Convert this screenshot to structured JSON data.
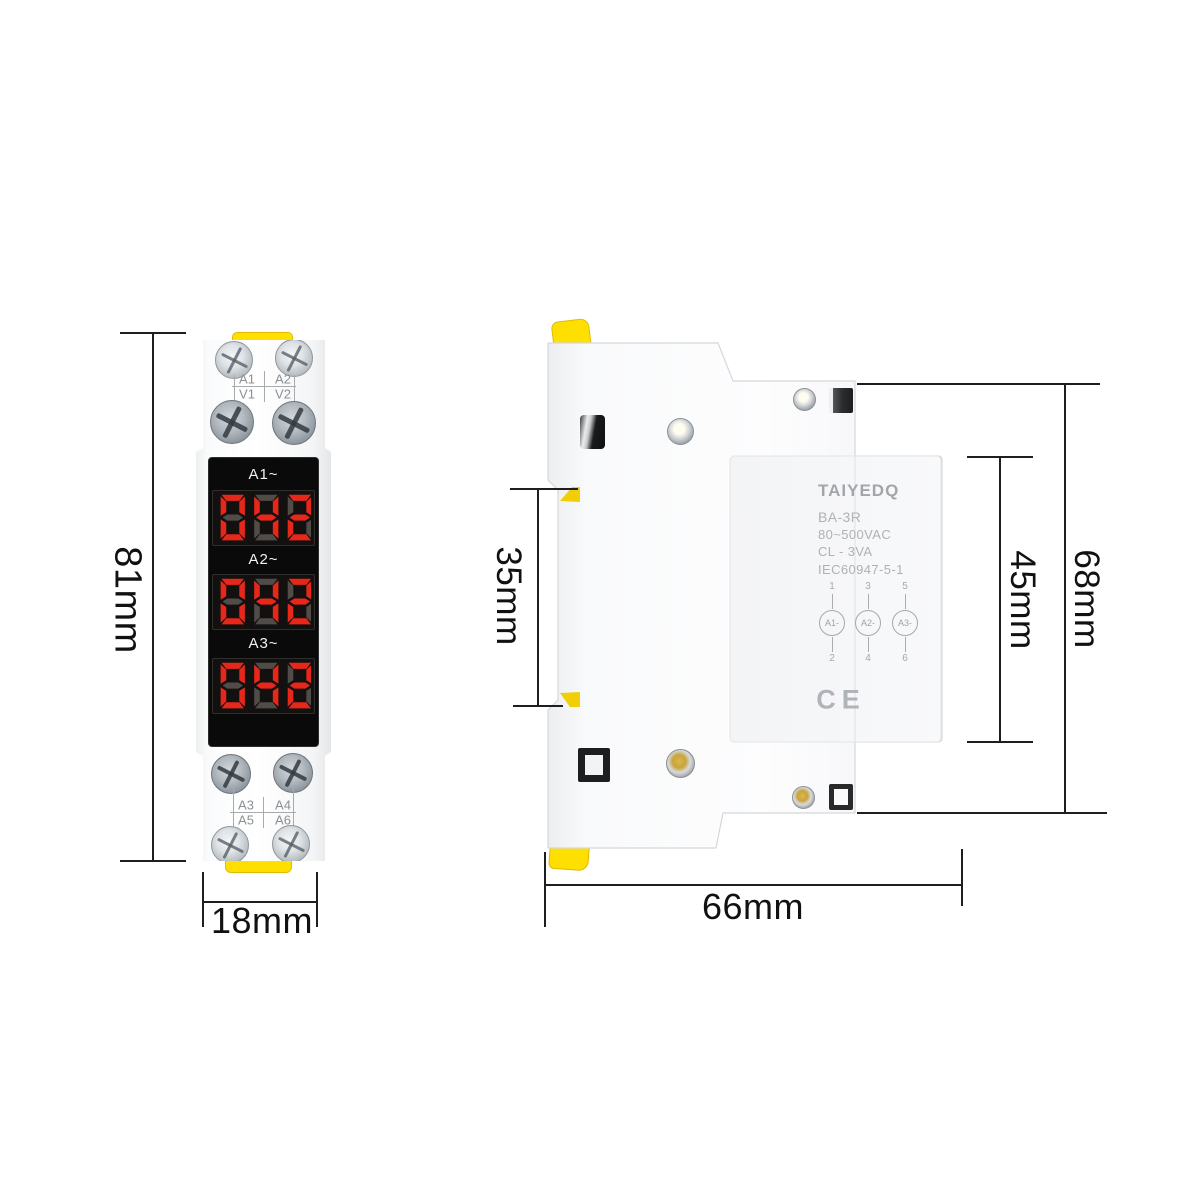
{
  "product": {
    "front_view": {
      "top_terminal_labels": [
        "A1",
        "A2",
        "V1",
        "V2"
      ],
      "bottom_terminal_labels": [
        "A3",
        "A4",
        "A5",
        "A6"
      ],
      "displays": [
        {
          "label": "A1~",
          "value": "042"
        },
        {
          "label": "A2~",
          "value": "042"
        },
        {
          "label": "A3~",
          "value": "042"
        }
      ],
      "height_dimension": "81mm",
      "width_dimension": "18mm"
    },
    "side_view": {
      "brand": "TAIYEDQ",
      "model": "BA-3R",
      "voltage_range": "80~500VAC",
      "power_rating": "CL - 3VA",
      "standard": "IEC60947-5-1",
      "terminal_columns": [
        {
          "top_number": "1",
          "label": "A1-",
          "bottom_number": "2"
        },
        {
          "top_number": "3",
          "label": "A2-",
          "bottom_number": "4"
        },
        {
          "top_number": "5",
          "label": "A3-",
          "bottom_number": "6"
        }
      ],
      "certification_mark": "CE",
      "rail_slot_dimension": "35mm",
      "body_height_dimension": "45mm",
      "total_height_dimension": "68mm",
      "depth_dimension": "66mm"
    }
  },
  "colors": {
    "din_clip_yellow": "#ffdf00",
    "display_panel_black": "#0a0a0b",
    "segment_lit": "#e8271b",
    "segment_unlit": "#514c48",
    "dimension_line": "#1e1e1e",
    "engraved_text_gray": "#a4a7ab"
  }
}
